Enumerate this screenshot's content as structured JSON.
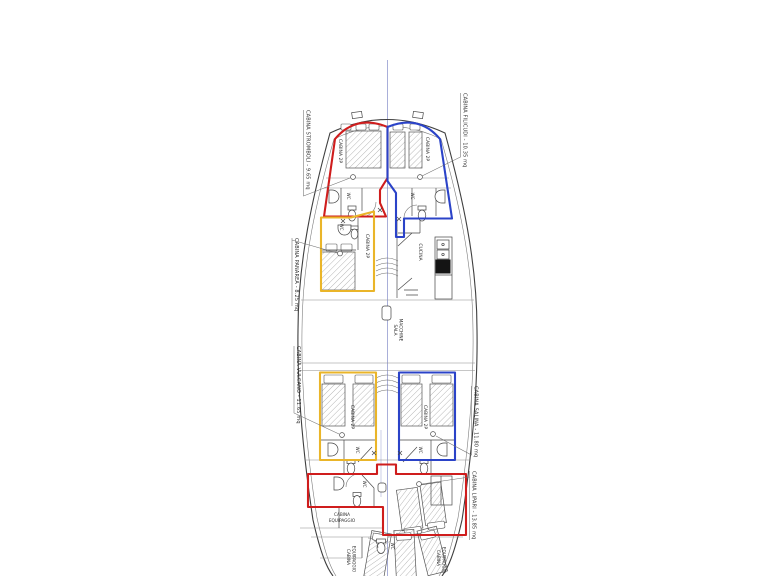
{
  "colors": {
    "red_zone": "#cf1d1d",
    "blue_zone": "#2b43c8",
    "yellow_zone": "#eab529",
    "centerline": "#a9afd9"
  },
  "side_labels": {
    "stromboli": "CABINA STROMBOLI - 9.65 mq",
    "filicudi": "CABINA FILICUDI - 10.35 mq",
    "panarea": "CABINA PANAREA - 8.25 mq",
    "vulcano": "CABINA VULCANO - 11.65 mq",
    "salina": "CABINA SALINA - 11.80 mq",
    "lipari": "CABINA LIPARI - 13.85 mq"
  },
  "room_labels": {
    "cabina_2p": "CABINA 2P",
    "cucina": "CUCINA",
    "sala": "SALA",
    "macchine": "MACCHINE",
    "wc": "WC",
    "cabina": "CABINA",
    "equipaggio": "EQUIPAGGIO"
  }
}
